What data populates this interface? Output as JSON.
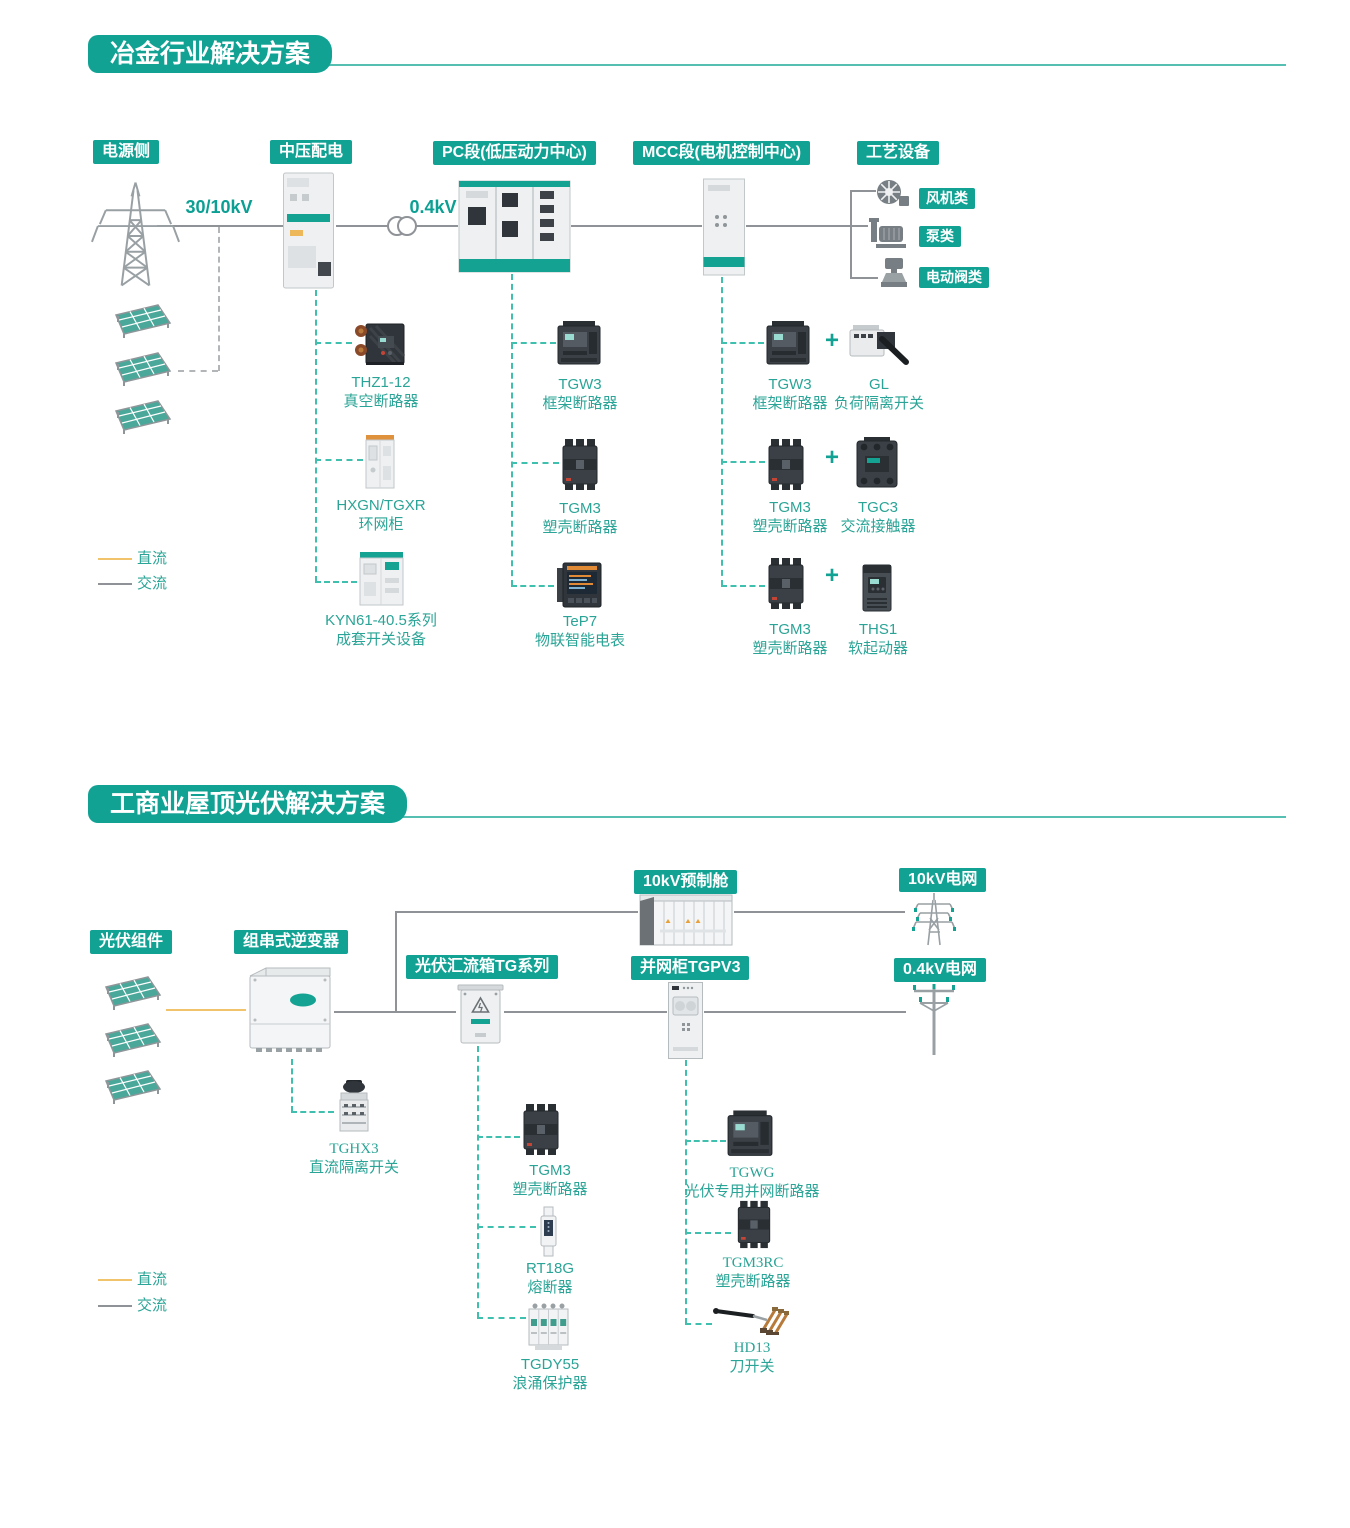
{
  "colors": {
    "primary": "#11a294",
    "dashed_branch": "#3fbfae",
    "dc_line": "#f1c46c",
    "ac_line": "#8f9398"
  },
  "section1": {
    "title": "冶金行业解决方案",
    "headers": {
      "source": "电源侧",
      "mv": "中压配电",
      "pc": "PC段(低压动力中心)",
      "mcc": "MCC段(电机控制中心)",
      "process": "工艺设备"
    },
    "voltages": {
      "incoming": "30/10kV",
      "lv": "0.4kV"
    },
    "process_items": [
      {
        "label": "风机类"
      },
      {
        "label": "泵类"
      },
      {
        "label": "电动阀类"
      }
    ],
    "mv_devices": [
      {
        "model": "THZ1-12",
        "desc": "真空断路器"
      },
      {
        "model": "HXGN/TGXR",
        "desc": "环网柜"
      },
      {
        "model": "KYN61-40.5系列",
        "desc": "成套开关设备"
      }
    ],
    "pc_devices": [
      {
        "model": "TGW3",
        "desc": "框架断路器"
      },
      {
        "model": "TGM3",
        "desc": "塑壳断路器"
      },
      {
        "model": "TeP7",
        "desc": "物联智能电表"
      }
    ],
    "mcc_rows": [
      {
        "breaker": {
          "model": "TGW3",
          "desc": "框架断路器"
        },
        "pair": {
          "model": "GL",
          "desc": "负荷隔离开关"
        }
      },
      {
        "breaker": {
          "model": "TGM3",
          "desc": "塑壳断路器"
        },
        "pair": {
          "model": "TGC3",
          "desc": "交流接触器"
        }
      },
      {
        "breaker": {
          "model": "TGM3",
          "desc": "塑壳断路器"
        },
        "pair": {
          "model": "THS1",
          "desc": "软起动器"
        }
      }
    ],
    "plus": "+",
    "legend": {
      "dc": "直流",
      "ac": "交流"
    }
  },
  "section2": {
    "title": "工商业屋顶光伏解决方案",
    "headers": {
      "pv": "光伏组件",
      "inverter": "组串式逆变器",
      "combiner": "光伏汇流箱TG系列",
      "grid_cabinet": "并网柜TGPV3",
      "cabin": "10kV预制舱",
      "grid_10kv": "10kV电网",
      "grid_04kv": "0.4kV电网"
    },
    "inverter_branch": {
      "model": "TGHX3",
      "desc": "直流隔离开关"
    },
    "combiner_devices": [
      {
        "model": "TGM3",
        "desc": "塑壳断路器"
      },
      {
        "model": "RT18G",
        "desc": "熔断器"
      },
      {
        "model": "TGDY55",
        "desc": "浪涌保护器"
      }
    ],
    "grid_devices": [
      {
        "model": "TGWG",
        "desc": "光伏专用并网断路器"
      },
      {
        "model": "TGM3RC",
        "desc": "塑壳断路器"
      },
      {
        "model": "HD13",
        "desc": "刀开关"
      }
    ],
    "legend": {
      "dc": "直流",
      "ac": "交流"
    }
  }
}
